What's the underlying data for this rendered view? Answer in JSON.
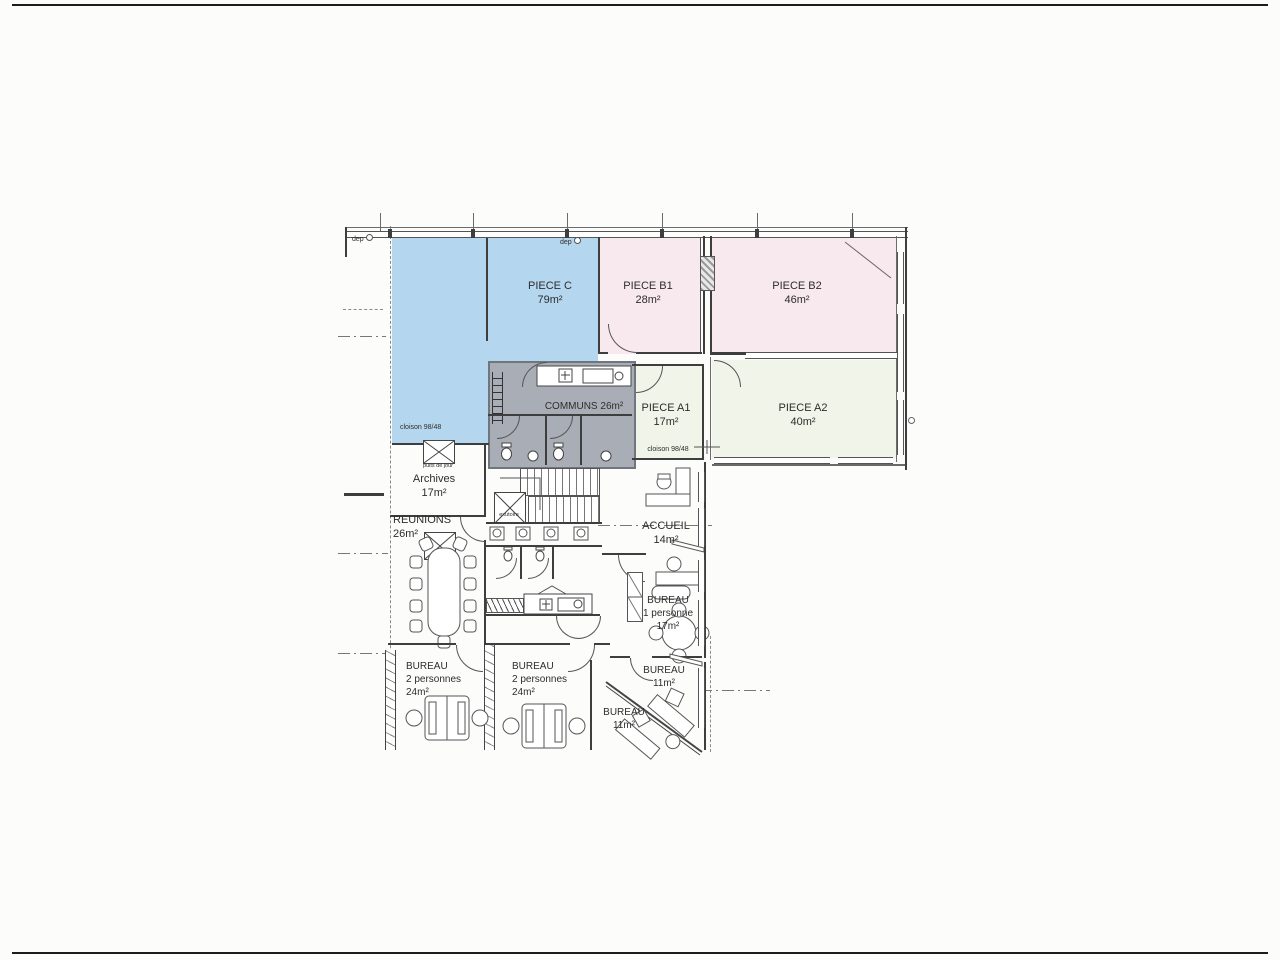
{
  "page": {
    "type_label": "scanned architectural floor plan"
  },
  "rooms": [
    {
      "name": "PIECE C",
      "area": "79m²"
    },
    {
      "name": "PIECE B1",
      "area": "28m²"
    },
    {
      "name": "PIECE B2",
      "area": "46m²"
    },
    {
      "name": "PIECE A1",
      "area": "17m²"
    },
    {
      "name": "PIECE A2",
      "area": "40m²"
    },
    {
      "name": "COMMUNS 26m²"
    },
    {
      "name": "Archives",
      "area": "17m²"
    },
    {
      "name": "REUNIONS",
      "area": "26m²"
    },
    {
      "name": "ACCUEIL",
      "area": "14m²"
    },
    {
      "name": "BUREAU",
      "sub": "1 personne",
      "area": "17m²"
    },
    {
      "name": "BUREAU",
      "sub": "2 personnes",
      "area": "24m²"
    },
    {
      "name": "BUREAU",
      "sub": "2 personnes",
      "area": "24m²"
    },
    {
      "name": "BUREAU",
      "area": "11m²"
    },
    {
      "name": "BUREAU",
      "area": "11m²"
    }
  ],
  "annotations": {
    "dep1": "dep",
    "dep2": "dep",
    "cloison_c": "cloison 98/48",
    "cloison_a1": "cloison 98/48",
    "puits_de_jour": "puits de jour",
    "exutoire": "exutoire"
  },
  "colors": {
    "room_blue": "#b5d6ef",
    "room_pink": "#f8e9ef",
    "room_cream": "#f1f4e9",
    "communs_gray": "#a9aeb6",
    "wall": "#3e3e3e"
  }
}
